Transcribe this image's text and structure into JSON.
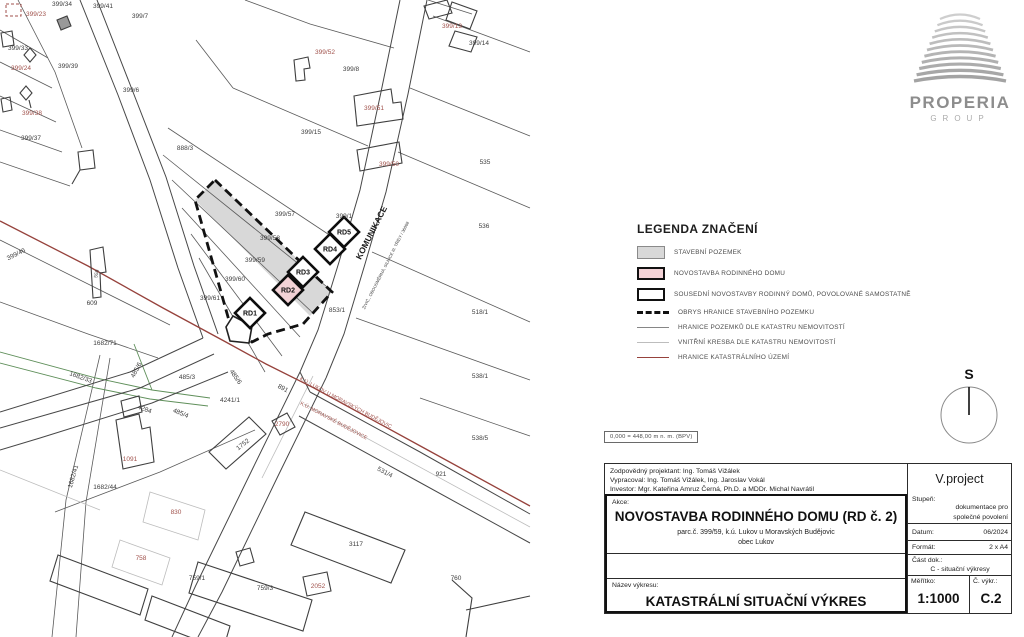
{
  "logo": {
    "name": "PROPERIA",
    "group": "GROUP"
  },
  "north_label": "S",
  "elevation_note": "0,000 = 448,00 m n. m. (BPV)",
  "legend": {
    "title": "LEGENDA ZNAČENÍ",
    "items": [
      {
        "type": "swatch-gray",
        "label": "STAVEBNÍ POZEMEK"
      },
      {
        "type": "swatch-pink",
        "label": "NOVOSTAVBA RODINNÉHO DOMU"
      },
      {
        "type": "swatch-outline",
        "label": "SOUSEDNÍ NOVOSTAVBY RODINNÝ DOMŮ, POVOLOVANÉ SAMOSTATNĚ"
      },
      {
        "type": "line-dashed",
        "label": "OBRYS HRANICE STAVEBNÍHO POZEMKU"
      },
      {
        "type": "line-thin",
        "label": "HRANICE POZEMKŮ DLE KATASTRU NEMOVITOSTÍ"
      },
      {
        "type": "line-light",
        "label": "VNITŘNÍ KRESBA DLE KATASTRU NEMOVITOSTÍ"
      },
      {
        "type": "line-red",
        "label": "HRANICE KATASTRÁLNÍHO ÚZEMÍ"
      }
    ]
  },
  "map": {
    "colors": {
      "label_dark": "#3d3d3d",
      "label_red": "#a0524c",
      "pink": "#f3d2d6",
      "gray": "#d8d8d8"
    },
    "labels": [
      {
        "t": "399/34",
        "x": 62,
        "y": 6
      },
      {
        "t": "399/23",
        "x": 36,
        "y": 16,
        "c": "r"
      },
      {
        "t": "399/41",
        "x": 103,
        "y": 8
      },
      {
        "t": "399/7",
        "x": 140,
        "y": 18
      },
      {
        "t": "399/33",
        "x": 18,
        "y": 50
      },
      {
        "t": "399/39",
        "x": 68,
        "y": 68
      },
      {
        "t": "399/24",
        "x": 21,
        "y": 70,
        "c": "r"
      },
      {
        "t": "399/6",
        "x": 131,
        "y": 92
      },
      {
        "t": "399/38",
        "x": 32,
        "y": 115,
        "c": "r"
      },
      {
        "t": "399/37",
        "x": 31,
        "y": 140
      },
      {
        "t": "888/3",
        "x": 185,
        "y": 150
      },
      {
        "t": "399/52",
        "x": 325,
        "y": 54,
        "c": "r"
      },
      {
        "t": "399/8",
        "x": 351,
        "y": 71
      },
      {
        "t": "399/13",
        "x": 452,
        "y": 28,
        "c": "r"
      },
      {
        "t": "399/14",
        "x": 479,
        "y": 45
      },
      {
        "t": "399/51",
        "x": 374,
        "y": 110,
        "c": "r"
      },
      {
        "t": "399/15",
        "x": 311,
        "y": 134
      },
      {
        "t": "399/50",
        "x": 389,
        "y": 166,
        "c": "r"
      },
      {
        "t": "535",
        "x": 485,
        "y": 164
      },
      {
        "t": "536",
        "x": 484,
        "y": 228
      },
      {
        "t": "518/1",
        "x": 480,
        "y": 314
      },
      {
        "t": "538/1",
        "x": 480,
        "y": 378
      },
      {
        "t": "538/5",
        "x": 480,
        "y": 440
      },
      {
        "t": "399/1",
        "x": 344,
        "y": 218
      },
      {
        "t": "399/57",
        "x": 285,
        "y": 216
      },
      {
        "t": "399/58",
        "x": 270,
        "y": 240
      },
      {
        "t": "399/59",
        "x": 255,
        "y": 262
      },
      {
        "t": "399/60",
        "x": 235,
        "y": 281
      },
      {
        "t": "399/61",
        "x": 210,
        "y": 300
      },
      {
        "t": "853/1",
        "x": 337,
        "y": 312
      },
      {
        "t": "399/46",
        "x": 17,
        "y": 256,
        "r": -27
      },
      {
        "t": "609",
        "x": 92,
        "y": 305
      },
      {
        "t": "1682/71",
        "x": 105,
        "y": 345
      },
      {
        "t": "1682/33",
        "x": 80,
        "y": 379,
        "r": 20
      },
      {
        "t": "485/6",
        "x": 138,
        "y": 371,
        "r": -62
      },
      {
        "t": "485/3",
        "x": 187,
        "y": 379
      },
      {
        "t": "485/6",
        "x": 234,
        "y": 378,
        "r": 55
      },
      {
        "t": "4241/1",
        "x": 230,
        "y": 402
      },
      {
        "t": "4284",
        "x": 144,
        "y": 411,
        "r": 20
      },
      {
        "t": "485/4",
        "x": 180,
        "y": 415,
        "r": 22
      },
      {
        "t": "891",
        "x": 282,
        "y": 390,
        "r": 28
      },
      {
        "t": "1682/41",
        "x": 75,
        "y": 477,
        "r": -74
      },
      {
        "t": "1682/44",
        "x": 105,
        "y": 489
      },
      {
        "t": "1091",
        "x": 130,
        "y": 461,
        "c": "r"
      },
      {
        "t": "1752",
        "x": 244,
        "y": 446,
        "r": -38
      },
      {
        "t": "2790",
        "x": 282,
        "y": 426,
        "c": "r"
      },
      {
        "t": "531/4",
        "x": 384,
        "y": 474,
        "r": 28
      },
      {
        "t": "921",
        "x": 441,
        "y": 476
      },
      {
        "t": "3117",
        "x": 356,
        "y": 546
      },
      {
        "t": "830",
        "x": 176,
        "y": 514,
        "c": "r"
      },
      {
        "t": "758",
        "x": 141,
        "y": 560,
        "c": "r"
      },
      {
        "t": "759/1",
        "x": 197,
        "y": 580
      },
      {
        "t": "759/3",
        "x": 265,
        "y": 590
      },
      {
        "t": "2052",
        "x": 318,
        "y": 588,
        "c": "r"
      },
      {
        "t": "760",
        "x": 456,
        "y": 580
      },
      {
        "t": "558",
        "x": 98,
        "y": 274,
        "r": -78,
        "s": 5
      },
      {
        "t": "KOMUNIKACE",
        "x": 374,
        "y": 234,
        "r": -63,
        "s": 8.5,
        "c": "k"
      },
      {
        "t": "ŽIVIČ., OBOUSMĚRNÁ, SILNICE III. TŘÍDY / 36068",
        "x": 387,
        "y": 266,
        "r": -63,
        "s": 4.2
      },
      {
        "t": "K.Ú. LUKOV U MORAVSKÝCH BUDĚJOVIC",
        "x": 345,
        "y": 404,
        "r": 28,
        "c": "r",
        "s": 5.2
      },
      {
        "t": "K.Ú. MORAVSKÉ BUDĚJOVICE",
        "x": 333,
        "y": 422,
        "r": 28,
        "c": "r",
        "s": 5.2
      }
    ],
    "rd_boxes": [
      {
        "label": "RD1",
        "x": 250,
        "y": 313,
        "fill": "white"
      },
      {
        "label": "RD2",
        "x": 288,
        "y": 290,
        "fill": "pink"
      },
      {
        "label": "RD3",
        "x": 303,
        "y": 272,
        "fill": "white"
      },
      {
        "label": "RD4",
        "x": 330,
        "y": 249,
        "fill": "white"
      },
      {
        "label": "RD5",
        "x": 344,
        "y": 232,
        "fill": "white"
      }
    ]
  },
  "titleblock": {
    "company": "V.project",
    "responsible": "Zodpovědný projektant: Ing. Tomáš Vižálek",
    "author": "Vypracoval: Ing. Tomáš Vižálek, Ing. Jaroslav Vokál",
    "investor": "Investor: Mgr. Kateřina Amruz Černá, Ph.D. a MDDr. Michal Navrátil",
    "akce_label": "Akce:",
    "akce_title": "NOVOSTAVBA RODINNÉHO DOMU (RD č. 2)",
    "akce_sub1": "parc.č. 399/59, k.ú. Lukov u Moravských Budějovic",
    "akce_sub2": "obec Lukov",
    "stupen_label": "Stupeň:",
    "stupen_value1": "dokumentace pro",
    "stupen_value2": "společné povolení",
    "datum_label": "Datum:",
    "datum_value": "06/2024",
    "format_label": "Formát:",
    "format_value": "2 x A4",
    "cast_label": "Část dok.:",
    "cast_value": "C - situační výkresy",
    "nazev_label": "Název výkresu:",
    "nazev_value": "KATASTRÁLNÍ SITUAČNÍ VÝKRES",
    "meritko_label": "Měřítko:",
    "meritko_value": "1:1000",
    "cislo_label": "Č. výkr.:",
    "cislo_value": "C.2"
  }
}
